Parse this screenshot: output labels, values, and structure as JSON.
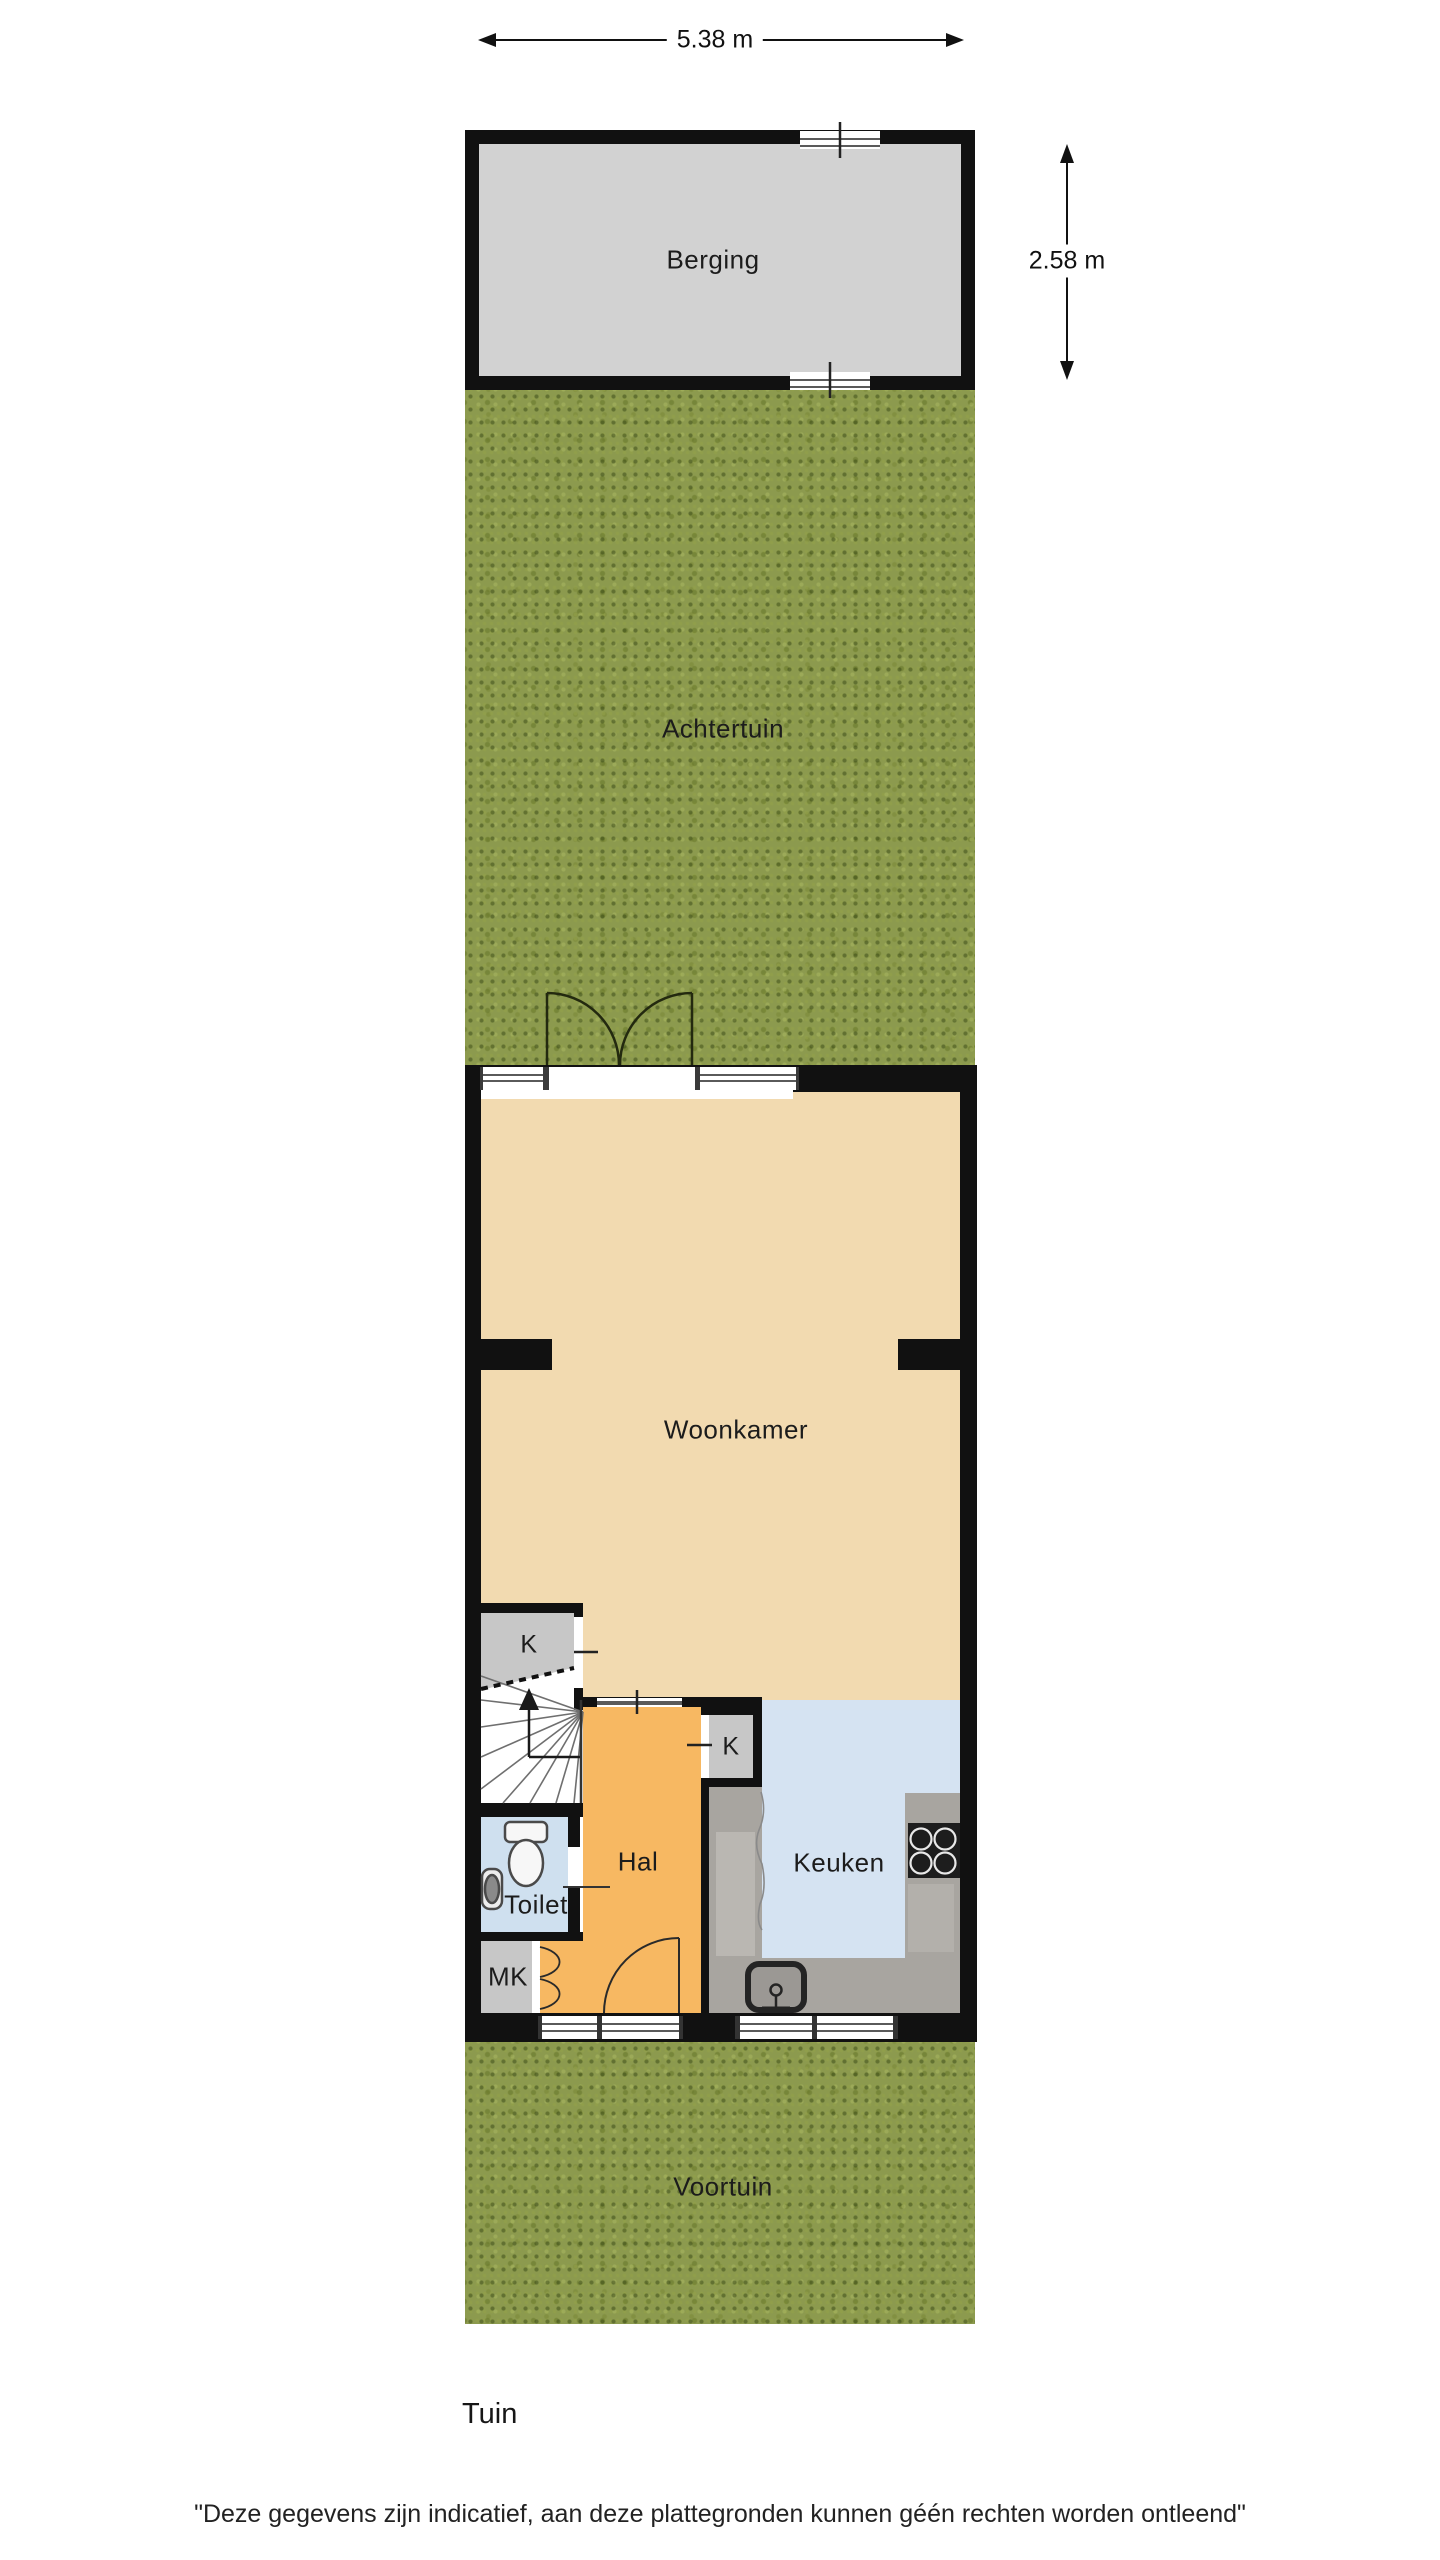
{
  "dimensions": {
    "width_label": "5.38 m",
    "height_label": "2.58 m"
  },
  "rooms": {
    "berging": "Berging",
    "achtertuin": "Achtertuin",
    "woonkamer": "Woonkamer",
    "hal": "Hal",
    "keuken": "Keuken",
    "toilet": "Toilet",
    "meterkast": "MK",
    "closet_stairs": "K",
    "closet_kitchen": "K",
    "voortuin": "Voortuin"
  },
  "captions": {
    "section_label": "Tuin",
    "disclaimer": "\"Deze gegevens zijn indicatief, aan deze plattegronden kunnen géén rechten worden ontleend\""
  },
  "colors": {
    "wall": "#111111",
    "grass": "#8c9a4e",
    "berging_floor": "#d2d2d2",
    "woonkamer_floor": "#f2dab0",
    "hal_floor": "#f7b862",
    "keuken_floor": "#d5e3f2",
    "toilet_floor": "#cfe0ef",
    "closet_floor": "#c7c7c7",
    "counter": "#a8a5a0",
    "stove": "#1d1d1d"
  }
}
